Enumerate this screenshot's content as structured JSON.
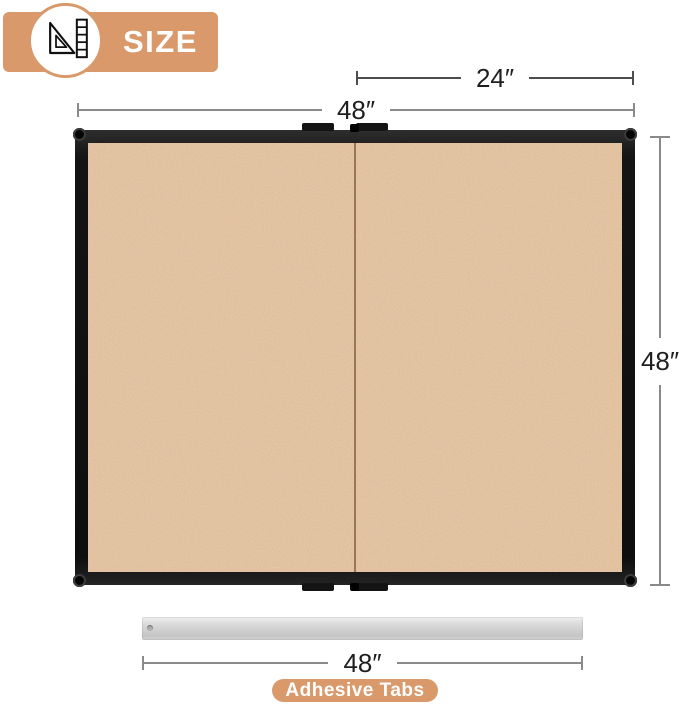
{
  "header": {
    "title": "SIZE",
    "badge_icon": "set-square-ruler-icon"
  },
  "dimensions": {
    "half_width_label": "24″",
    "full_width_label": "48″",
    "height_label": "48″",
    "bar_width_label": "48″"
  },
  "adhesive": {
    "label": "Adhesive Tabs"
  },
  "colors": {
    "accent_tan": "#D9996B",
    "cork": "#C28B5E",
    "frame_black": "#141414",
    "dim_line_gray": "#8A8A8A",
    "dim_line_dark": "#4D4D4D",
    "dim_text": "#1F1F1F",
    "adhesive_bar_gray": "#CDCDCD",
    "label_text_white": "#FFFFFF"
  }
}
